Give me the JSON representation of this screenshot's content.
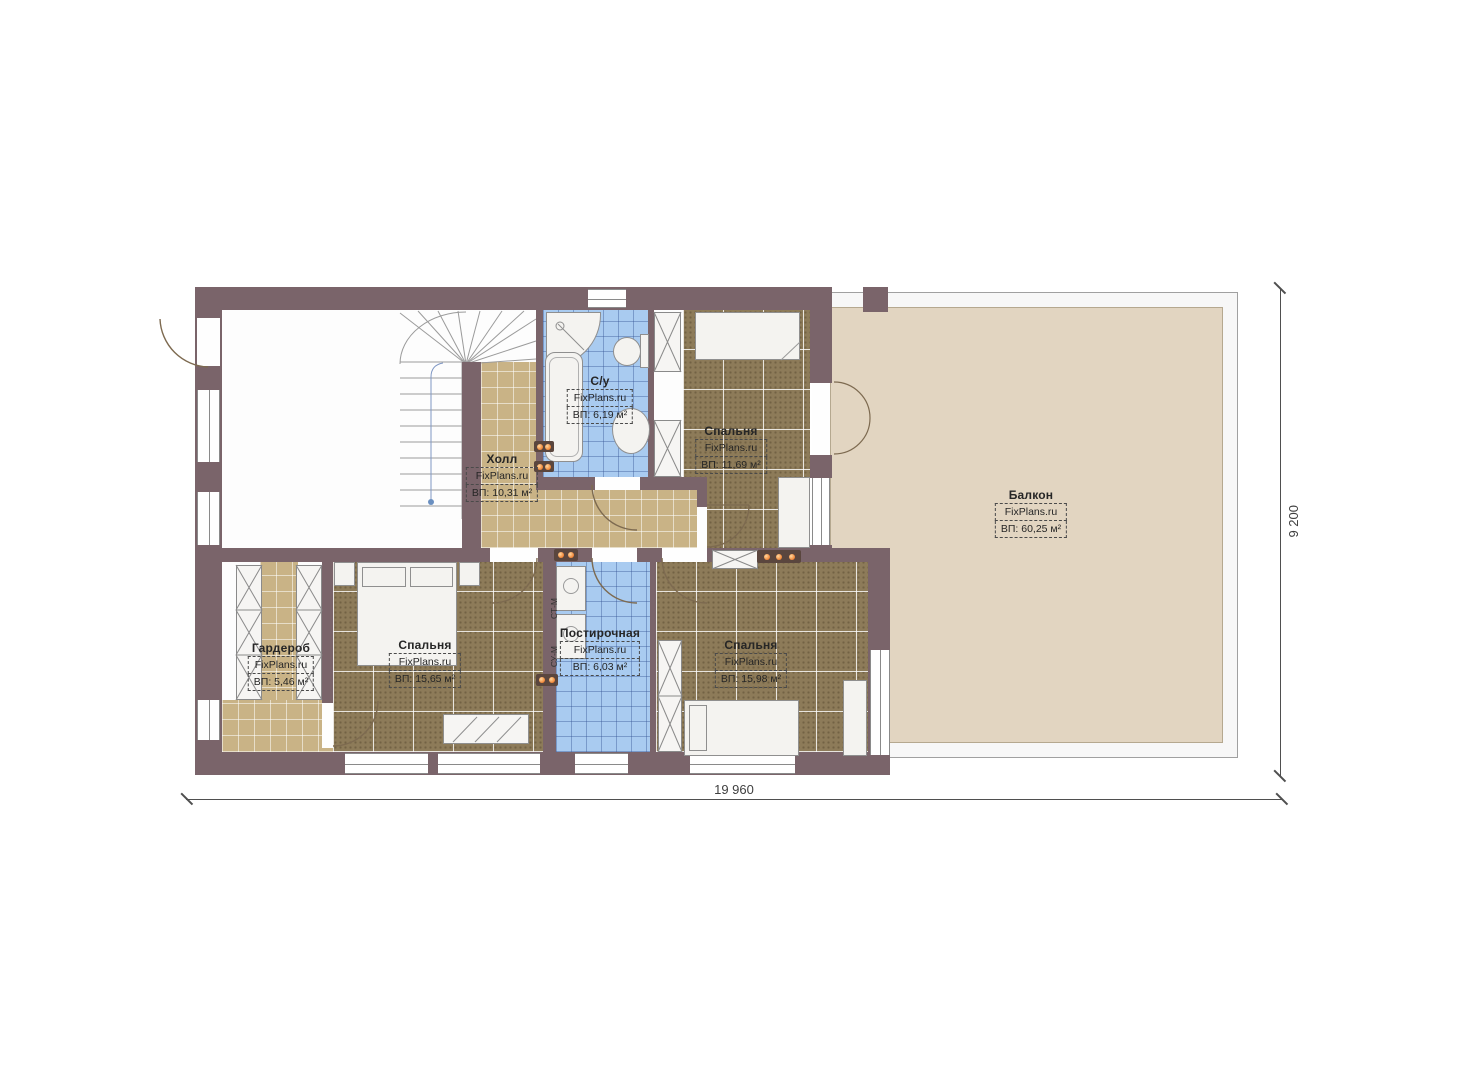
{
  "brand": "FixPlans.ru",
  "rooms": {
    "hall": {
      "name": "Холл",
      "brand": "FixPlans.ru",
      "area": "ВП: 10,31 м²"
    },
    "bathroom": {
      "name": "С/у",
      "brand": "FixPlans.ru",
      "area": "ВП: 6,19 м²"
    },
    "bedroom_top": {
      "name": "Спальня",
      "brand": "FixPlans.ru",
      "area": "ВП: 11,69 м²"
    },
    "balcony": {
      "name": "Балкон",
      "brand": "FixPlans.ru",
      "area": "ВП: 60,25 м²"
    },
    "wardrobe": {
      "name": "Гардероб",
      "brand": "FixPlans.ru",
      "area": "ВП: 5,46 м²"
    },
    "bedroom_left": {
      "name": "Спальня",
      "brand": "FixPlans.ru",
      "area": "ВП: 15,65 м²"
    },
    "laundry": {
      "name": "Постирочная",
      "brand": "FixPlans.ru",
      "area": "ВП: 6,03 м²"
    },
    "bedroom_right": {
      "name": "Спальня",
      "brand": "FixPlans.ru",
      "area": "ВП: 15,98 м²"
    }
  },
  "appliances": {
    "washing_machine": "СТ-М",
    "drying_machine": "СУ-М"
  },
  "dimensions": {
    "width_label": "19 960",
    "height_label": "9 200"
  },
  "colors": {
    "wall": "#7a646a",
    "carpet": "#8d7b59",
    "tile_tan": "#c9b386",
    "tile_blue": "#a9cbf0",
    "balcony": "#e2d5c1",
    "socket_accent": "#f07f2e"
  }
}
